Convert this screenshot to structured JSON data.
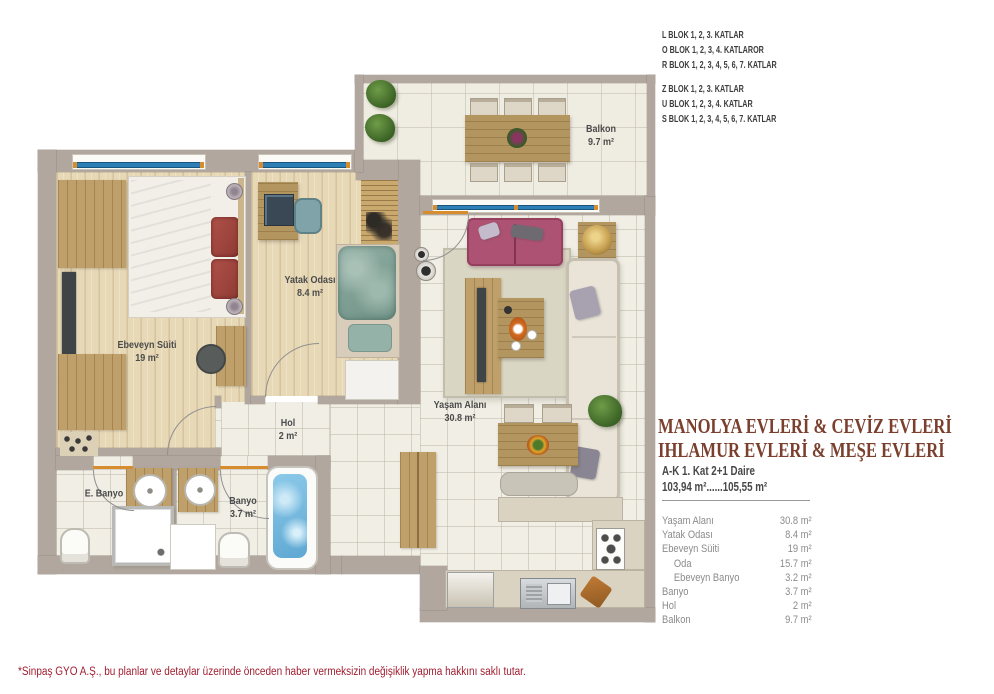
{
  "header": {
    "block_groups": [
      {
        "lines": [
          "L BLOK 1, 2, 3. KATLAR",
          "O BLOK 1, 2, 3, 4. KATLAROR",
          "R BLOK 1, 2, 3, 4, 5, 6, 7.  KATLAR"
        ]
      },
      {
        "lines": [
          "Z BLOK 1, 2, 3. KATLAR",
          "U BLOK 1, 2, 3, 4. KATLAR",
          "S BLOK 1, 2, 3, 4, 5, 6, 7.  KATLAR"
        ]
      }
    ]
  },
  "sidebar": {
    "title_line1": "MANOLYA EVLERİ & CEVİZ EVLERİ",
    "title_line2": "IHLAMUR EVLERİ & MEŞE EVLERİ",
    "subtitle": "A-K 1. Kat  2+1 Daire",
    "area_range": "103,94 m²......105,55 m²",
    "area_table": {
      "rows": [
        {
          "label": "Yaşam Alanı",
          "value": "30.8 m²"
        },
        {
          "label": "Yatak Odası",
          "value": "8.4 m²"
        },
        {
          "label": "Ebeveyn Süiti",
          "value": "19 m²"
        },
        {
          "label": "Oda",
          "value": "15.7 m²"
        },
        {
          "label": "Ebeveyn Banyo",
          "value": "3.2 m²"
        },
        {
          "label": "Banyo",
          "value": "3.7 m²"
        },
        {
          "label": "Hol",
          "value": "2 m²"
        },
        {
          "label": "Balkon",
          "value": "9.7 m²"
        }
      ]
    }
  },
  "plan": {
    "rooms": {
      "ebeveyn": {
        "name": "Ebeveyn Süiti",
        "area": "19 m²"
      },
      "yatak": {
        "name": "Yatak Odası",
        "area": "8.4 m²"
      },
      "hol": {
        "name": "Hol",
        "area": "2 m²"
      },
      "yasam": {
        "name": "Yaşam Alanı",
        "area": "30.8 m²"
      },
      "balkon": {
        "name": "Balkon",
        "area": "9.7 m²"
      },
      "ebanyo": {
        "name": "E. Banyo"
      },
      "banyo": {
        "name": "Banyo",
        "area": "3.7 m²"
      }
    }
  },
  "footer": {
    "disclaimer": "*Sinpaş GYO A.Ş., bu planlar ve detaylar üzerinde önceden haber vermeksizin değişiklik yapma hakkını saklı tutar."
  },
  "colors": {
    "title-brown": "#7a3f2d",
    "block-text": "#3c3c3c",
    "table-gray": "#8b8b8b",
    "disclaimer-red": "#a01d30",
    "wall": "#b1a79e",
    "window-blue": "#2d7fb5"
  }
}
